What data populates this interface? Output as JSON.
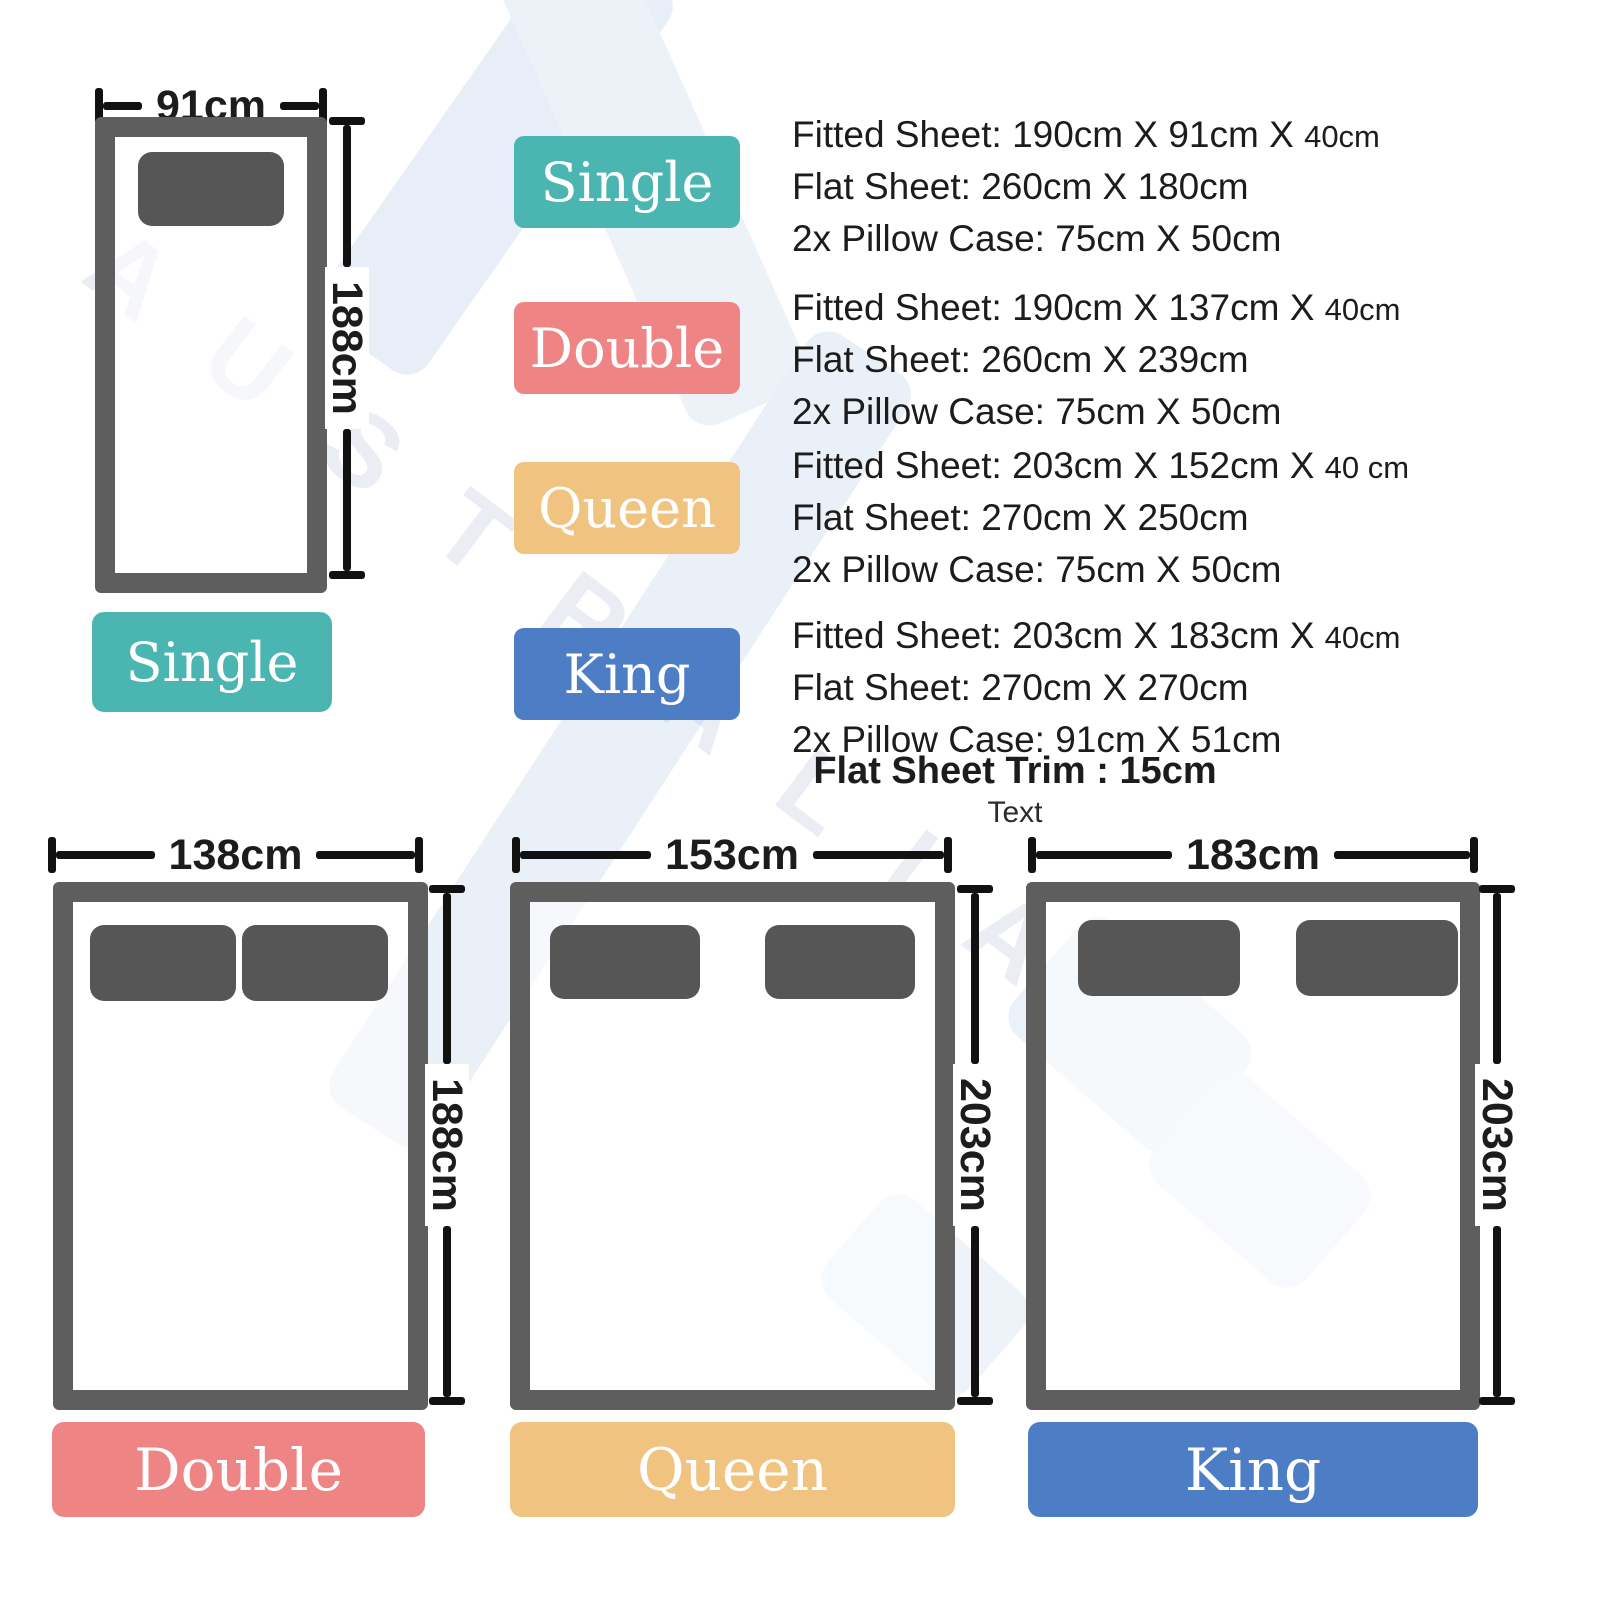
{
  "colors": {
    "single": "#4bb5b1",
    "double": "#ef8485",
    "queen": "#f1c380",
    "king": "#4d7dc5",
    "frame": "#5e5e5e",
    "pillow": "#565656",
    "dim_line": "#111111"
  },
  "watermark": {
    "text": "AUSTRALIA"
  },
  "legend": {
    "items": [
      {
        "label": "Single",
        "lines": [
          {
            "main": "Fitted Sheet: 190cm X 91cm X ",
            "small": "40cm"
          },
          {
            "main": "Flat Sheet: 260cm X 180cm",
            "small": ""
          },
          {
            "main": "2x Pillow Case: 75cm X 50cm",
            "small": ""
          }
        ]
      },
      {
        "label": "Double",
        "lines": [
          {
            "main": "Fitted Sheet: 190cm X 137cm X ",
            "small": "40cm"
          },
          {
            "main": "Flat Sheet: 260cm X 239cm",
            "small": ""
          },
          {
            "main": "2x Pillow Case: 75cm X 50cm",
            "small": ""
          }
        ]
      },
      {
        "label": "Queen",
        "lines": [
          {
            "main": "Fitted Sheet: 203cm X 152cm X ",
            "small": "40 cm"
          },
          {
            "main": "Flat Sheet: 270cm X 250cm",
            "small": ""
          },
          {
            "main": "2x Pillow Case: 75cm X 50cm",
            "small": ""
          }
        ]
      },
      {
        "label": "King",
        "lines": [
          {
            "main": "Fitted Sheet: 203cm X 183cm X ",
            "small": "40cm"
          },
          {
            "main": "Flat Sheet: 270cm X 270cm",
            "small": ""
          },
          {
            "main": "2x Pillow Case: 91cm X 51cm",
            "small": ""
          }
        ]
      }
    ],
    "trim_note": "Flat Sheet Trim : 15cm",
    "footnote": "Text"
  },
  "beds": [
    {
      "name": "Single",
      "width_label": "91cm",
      "height_label": "188cm"
    },
    {
      "name": "Double",
      "width_label": "138cm",
      "height_label": "188cm"
    },
    {
      "name": "Queen",
      "width_label": "153cm",
      "height_label": "203cm"
    },
    {
      "name": "King",
      "width_label": "183cm",
      "height_label": "203cm"
    }
  ]
}
